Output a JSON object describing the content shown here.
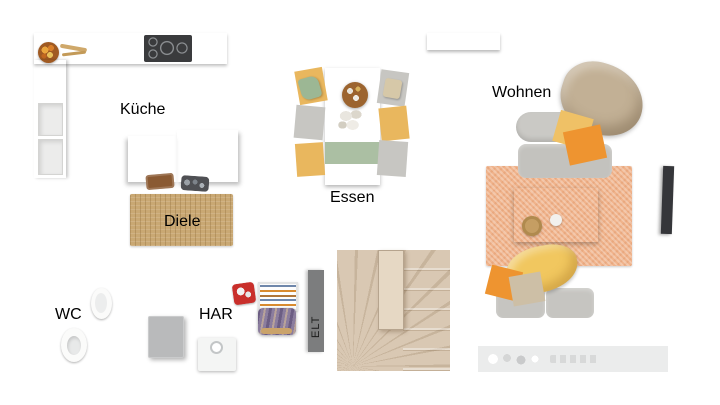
{
  "rooms": {
    "kueche": {
      "label": "Küche"
    },
    "diele": {
      "label": "Diele"
    },
    "essen": {
      "label": "Essen"
    },
    "wohnen": {
      "label": "Wohnen"
    },
    "wc": {
      "label": "WC"
    },
    "har": {
      "label": "HAR"
    },
    "elt": {
      "label": "ELT"
    }
  },
  "palette": {
    "wall": "#595959",
    "wood": "#d9c9b4",
    "wood_light": "#ddd3c6",
    "tile": "#dcdddd",
    "stair": "#d9c8b3",
    "glass": "#cfe2ec",
    "furniture_white": "#f6f6f5",
    "jute": "#c9a873",
    "rug_orange": "#f0b38b",
    "sofa": "#bcbbb7",
    "chair_yellow": "#e9b75e",
    "chair_gray": "#c7c6c2",
    "runner_green": "#abbfa3",
    "pillow_yellow": "#efc166",
    "pillow_orange": "#ee9430",
    "blanket_tan": "#c2b095",
    "plant_green": "#63a437",
    "red_item": "#c92f2b",
    "elt_gray": "#7c7d7e"
  }
}
